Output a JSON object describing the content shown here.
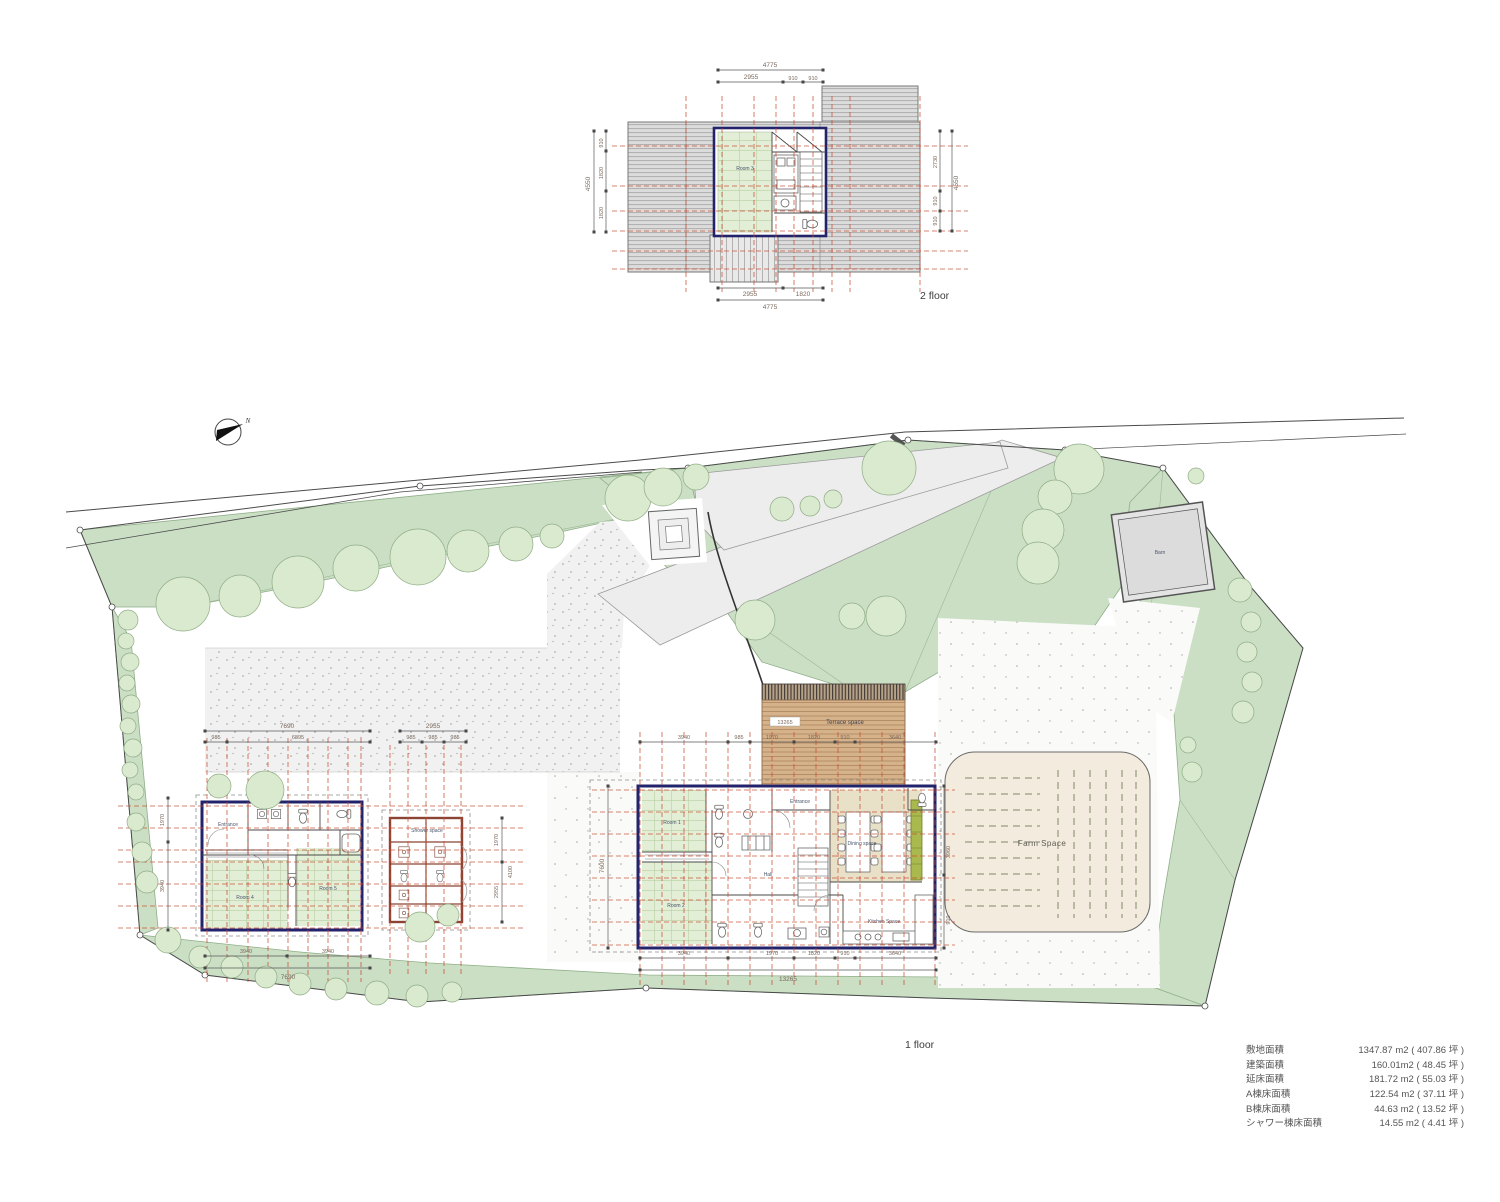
{
  "colors": {
    "wall_navy": "#23236b",
    "dim_red_dash": "#c8492e",
    "tatami_green": "#e3eed6",
    "site_green": "#cbdfc5",
    "tree_green": "#daeace",
    "deck_tan": "#d6b28a",
    "dining_beige": "#e9e0c8",
    "farm_beige": "#f3ebdd",
    "bench_olive": "#a9b94e",
    "roof_gray": "#dcdcdc",
    "gravel_gray": "#f1f1f1"
  },
  "captions": {
    "floor2": "2 floor",
    "floor1": "1 floor",
    "north": "N"
  },
  "labels": {
    "room2f": "Room 3",
    "main_entrance": "Entrance",
    "main_room1": "Room 1",
    "main_room2": "Room 2",
    "hall": "Hall",
    "dining": "Dining space",
    "kitchen": "Kitchen Space",
    "annex_entrance": "Entrance",
    "annex_room4": "Room 4",
    "annex_room5": "Room 5",
    "shower": "Shower space",
    "terrace": "Terrace space",
    "farm": "Farm Space",
    "barn": "Barn"
  },
  "dims": [
    "4775",
    "2955",
    "910",
    "910",
    "2955",
    "1820",
    "4775",
    "910",
    "1820",
    "1820",
    "4550",
    "2730",
    "4550",
    "910",
    "910",
    "7690",
    "985",
    "6895",
    "2955",
    "985",
    "985",
    "985",
    "3940",
    "985",
    "1970",
    "1820",
    "910",
    "3640",
    "13265",
    "3940",
    "1970",
    "1820",
    "910",
    "3640",
    "13265",
    "3940",
    "3940",
    "7690",
    "1970",
    "3940",
    "1970",
    "2955",
    "4100",
    "7600",
    "3960",
    "910"
  ],
  "area_table": {
    "rows": [
      {
        "label": "敷地面積",
        "value": "1347.87 m2 ( 407.86 坪 )"
      },
      {
        "label": "建築面積",
        "value": "160.01m2 (  48.45 坪 )"
      },
      {
        "label": "延床面積",
        "value": "181.72 m2 (  55.03 坪 )"
      },
      {
        "label": "A棟床面積",
        "value": "122.54 m2 (  37.11 坪 )"
      },
      {
        "label": "B棟床面積",
        "value": "44.63 m2 (  13.52 坪 )"
      },
      {
        "label": "シャワー棟床面積",
        "value": "14.55 m2 (   4.41 坪 )"
      }
    ]
  }
}
